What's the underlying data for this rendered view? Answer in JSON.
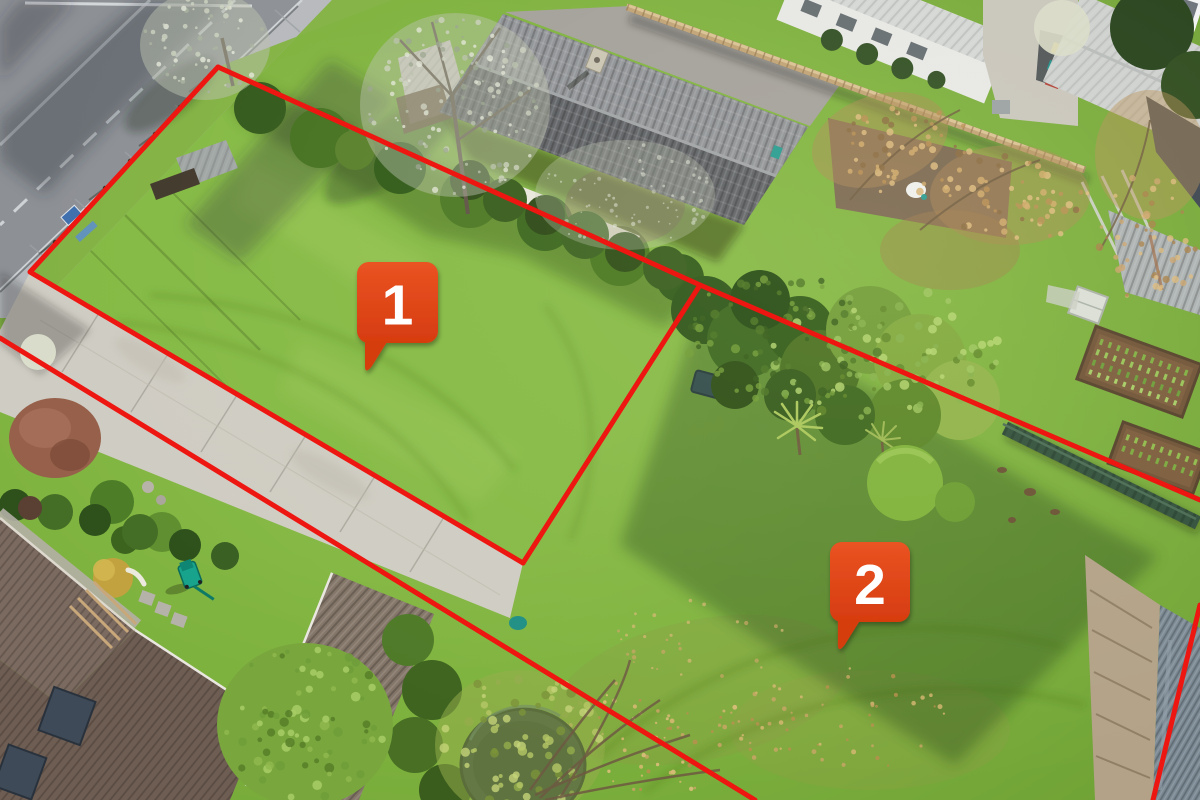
{
  "canvas": {
    "width": 1200,
    "height": 800
  },
  "scene_palette": {
    "lawn_green": "#7fb33f",
    "road_gray": "#8d9095",
    "concrete_gray": "#cfccc3",
    "roof_dark_gray": "#5c5f64",
    "tile_roof_brown": "#6e5d52"
  },
  "boundary": {
    "color": "#ee1611",
    "stroke_width": 5,
    "lines": [
      {
        "name": "north-boundary",
        "points": [
          [
            218,
            67
          ],
          [
            700,
            285
          ],
          [
            1200,
            500
          ]
        ]
      },
      {
        "name": "west-boundary-and-driveway-edge",
        "points": [
          [
            218,
            67
          ],
          [
            30,
            272
          ],
          [
            523,
            563
          ]
        ]
      },
      {
        "name": "lot-divider",
        "points": [
          [
            700,
            285
          ],
          [
            523,
            563
          ]
        ]
      },
      {
        "name": "south-boundary",
        "points": [
          [
            0,
            338
          ],
          [
            755,
            800
          ]
        ]
      },
      {
        "name": "east-boundary",
        "points": [
          [
            1200,
            605
          ],
          [
            1153,
            800
          ]
        ]
      }
    ]
  },
  "marker_style": {
    "fill_top": "#ea5322",
    "fill_bottom": "#d63c10",
    "text_color": "#ffffff",
    "font_size": 57,
    "corner_radius": 12
  },
  "markers": [
    {
      "id": "lot-1",
      "label": "1",
      "x": 357,
      "y": 262,
      "size": 81
    },
    {
      "id": "lot-2",
      "label": "2",
      "x": 830,
      "y": 542,
      "size": 80
    }
  ]
}
